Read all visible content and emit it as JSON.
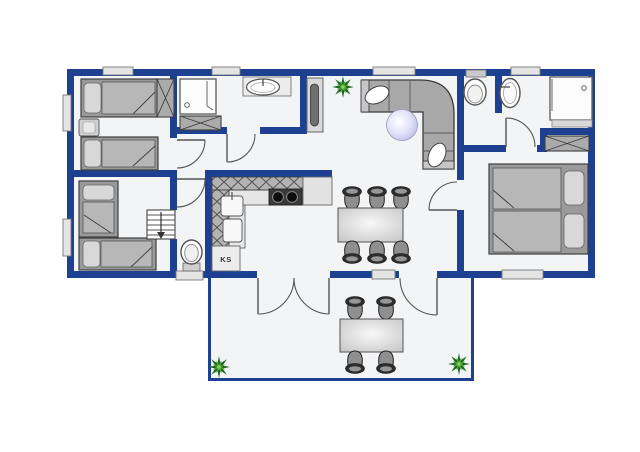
{
  "title": "Holiday house floor plan",
  "labels": {
    "fridge": "KS"
  },
  "colors": {
    "wall": "#1d4091",
    "floor": "#f3f4f6",
    "window": "#e4e4e4",
    "furniture_gray": "#b5b5b5",
    "furniture_light": "#dcdcdc",
    "chair_dark": "#2d2d2d",
    "plant_green_dark": "#1d6b21",
    "plant_green_light": "#4fa233",
    "lamp": "#c8c8ec",
    "outline": "#4a4a4a"
  },
  "rooms": [
    {
      "name": "bedroom-1",
      "furniture": [
        "single-bed",
        "single-bed",
        "nightstand",
        "wardrobe"
      ]
    },
    {
      "name": "bathroom-1",
      "furniture": [
        "shower",
        "washbasin",
        "wardrobe"
      ]
    },
    {
      "name": "bedroom-2",
      "furniture": [
        "single-bed",
        "single-bed",
        "entry-steps"
      ]
    },
    {
      "name": "wc",
      "furniture": [
        "toilet"
      ]
    },
    {
      "name": "hallway",
      "furniture": [
        "tall-cabinet"
      ]
    },
    {
      "name": "kitchen",
      "furniture": [
        "upper-cabinets",
        "counter",
        "stove",
        "sink",
        "refrigerator"
      ]
    },
    {
      "name": "living-room",
      "furniture": [
        "corner-sofa",
        "floor-lamp",
        "plant"
      ]
    },
    {
      "name": "dining-area",
      "furniture": [
        "dining-table"
      ],
      "chairs": 6
    },
    {
      "name": "bathroom-2",
      "furniture": [
        "toilet",
        "washbasin",
        "shower",
        "wardrobe"
      ]
    },
    {
      "name": "bedroom-3",
      "furniture": [
        "double-bed",
        "wardrobe"
      ]
    },
    {
      "name": "terrace",
      "furniture": [
        "garden-table",
        "plant",
        "plant"
      ],
      "chairs": 4
    }
  ],
  "window_count": 9,
  "door_count": 8
}
